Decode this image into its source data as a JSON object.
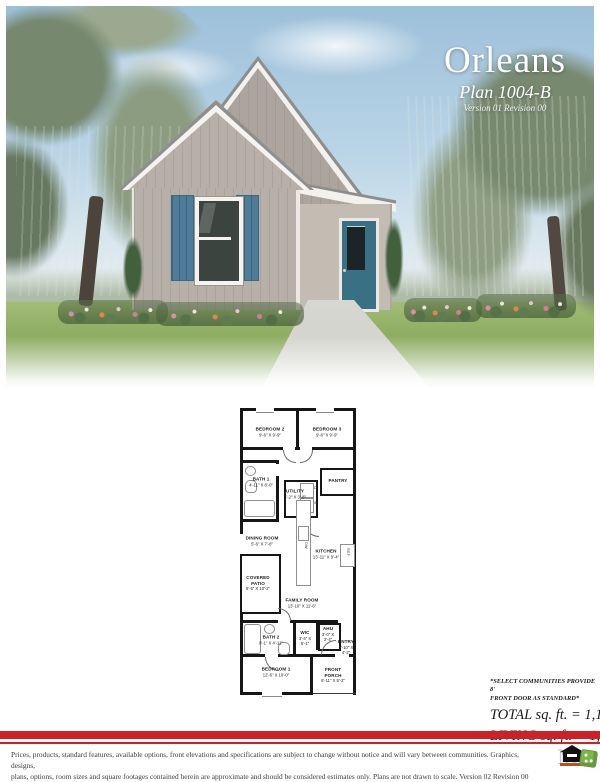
{
  "hero": {
    "title": "Orleans",
    "subtitle": "Plan 1004-B",
    "version": "Version 01 Revision 00"
  },
  "floorplan": {
    "rooms": [
      {
        "name": "BEDROOM 2",
        "dims": "9'-6\" X 9'-9\""
      },
      {
        "name": "BEDROOM 3",
        "dims": "9'-6\" X 9'-9\""
      },
      {
        "name": "BATH 1",
        "dims": "4'-11\" X 8'-0\""
      },
      {
        "name": "UTILITY",
        "dims": "4'-2\" X 3'-8\""
      },
      {
        "name": "PANTRY",
        "dims": ""
      },
      {
        "name": "DINING ROOM",
        "dims": "5'-6\" X 7'-8\""
      },
      {
        "name": "KITCHEN",
        "dims": "13'-11\" X 9'-4\""
      },
      {
        "name": "COVERED PATIO",
        "dims": "5'-5\" X 10'-2\""
      },
      {
        "name": "FAMILY ROOM",
        "dims": "13'-10\" X 11'-6\""
      },
      {
        "name": "BATH 2",
        "dims": "8'-1\" X 4'-11\""
      },
      {
        "name": "WIC",
        "dims": "3'-4\" X 5'-1\""
      },
      {
        "name": "AHU",
        "dims": "3'-0\" X 2'-4\""
      },
      {
        "name": "ENTRY",
        "dims": "3'-10\" X 4'-2\""
      },
      {
        "name": "BEDROOM 1",
        "dims": "12'-6\" X 10'-0\""
      },
      {
        "name": "FRONT PORCH",
        "dims": "6'-11\" X 5'-2\""
      }
    ],
    "appliances": {
      "dw": "DW",
      "ref": "REF",
      "washer": "W",
      "dryer": "D"
    }
  },
  "summary": {
    "note_line1": "*SELECT COMMUNITIES PROVIDE 8'",
    "note_line2": "FRONT DOOR AS STANDARD*",
    "total": "TOTAL sq. ft. = 1,108",
    "living": "LIVING sq. ft. = 1,004"
  },
  "footer": {
    "disclaimer_line1": "Prices, products, standard features, available options, front elevations and specifications are subject to change without notice and will vary between communities.  Graphics, designs,",
    "disclaimer_line2": "plans, options, room sizes and square footages contained herein are approximate and should be considered estimates only.  Plans are not drawn to scale.    Version 02 Revision 00",
    "logo_letter": "M"
  },
  "colors": {
    "accent_red": "#d02027",
    "door_teal": "#3a7083",
    "shutter_blue": "#4e7c99",
    "siding_greige": "#b7b0a9"
  }
}
